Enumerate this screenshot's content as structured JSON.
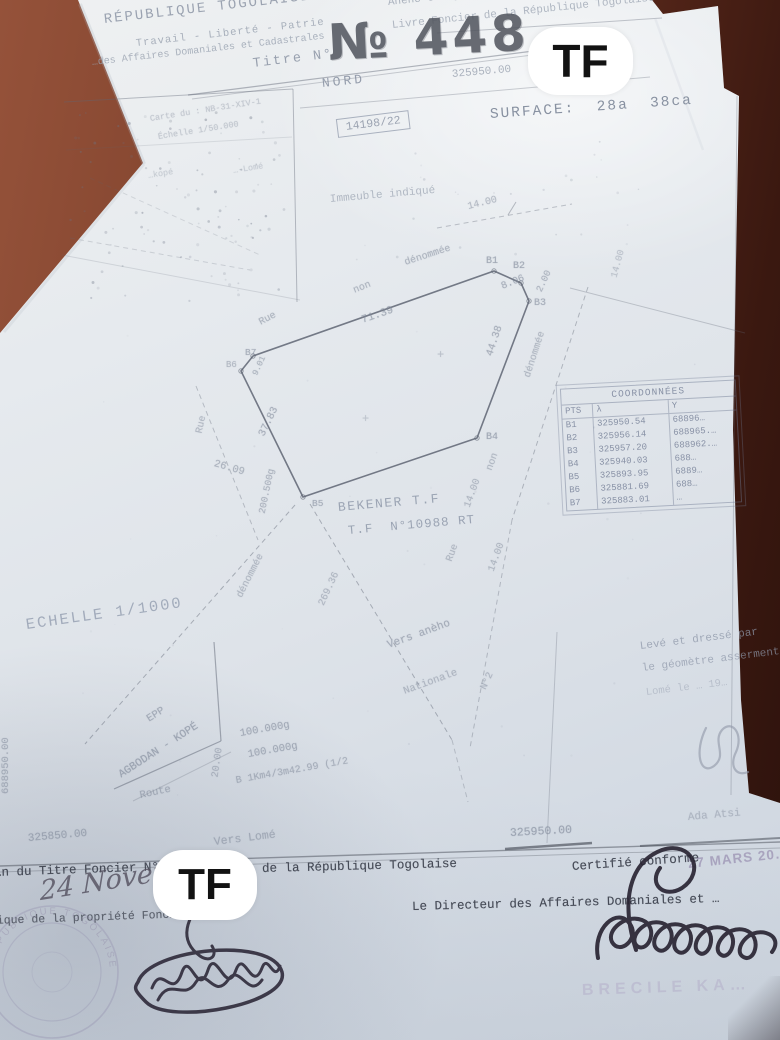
{
  "badges": {
    "tf": "TF"
  },
  "colors": {
    "paper": "#e2e6ec",
    "table_wood": "#7a3f2c",
    "ink_faded": "#8a93a3",
    "ink_dark": "#454a56",
    "stamp_purple": "#8f82a8",
    "badge_bg": "#ffffff",
    "badge_text": "#121212"
  },
  "header": {
    "republic": "RÉPUBLIQUE TOGOLAISE",
    "motto": "Travail - Liberté - Patrie",
    "direction": "…des Affaires Domaniales et Cadastrales",
    "titre_label": "Titre N°",
    "titre_number": "№ 448",
    "office_line1": "Aného Gbodjomé (Pref./LACS)",
    "office_line2": "Livre Foncier de la République Togolaise",
    "grid_x_top": "325950.00",
    "nord": "NORD",
    "surface": "SURFACE:  28a  38ca",
    "file_stamp": "14198/22",
    "immeuble": "Immeuble indiqué"
  },
  "plan": {
    "scale": "ECHELLE 1/1000",
    "owner_line1": "BEKENER T.F",
    "owner_line2": "T.F  N°10988 RT",
    "polygon": {
      "points": [
        [
          494,
          271
        ],
        [
          521,
          283
        ],
        [
          529,
          301
        ],
        [
          477,
          438
        ],
        [
          303,
          497
        ],
        [
          241,
          371
        ],
        [
          253,
          356
        ]
      ]
    },
    "labels": [
      {
        "n": "inset-carte-ref",
        "t": "Carte du : NB-31-XIV-1",
        "x": 150,
        "y": 114,
        "r": -9,
        "s": 8.5,
        "o": 0.38
      },
      {
        "n": "inset-echelle",
        "t": "Échelle 1/50.000",
        "x": 158,
        "y": 132,
        "r": -9,
        "s": 8.5,
        "o": 0.38
      },
      {
        "n": "inset-kope",
        "t": "…kopé",
        "x": 148,
        "y": 171,
        "r": -9,
        "s": 8.5,
        "o": 0.32
      },
      {
        "n": "inset-lome",
        "t": "…-Lomé",
        "x": 233,
        "y": 166,
        "r": -9,
        "s": 8.5,
        "o": 0.32
      },
      {
        "n": "street-north-width",
        "t": "14.00",
        "x": 468,
        "y": 202,
        "r": -14,
        "s": 10,
        "o": 0.5
      },
      {
        "n": "rue-top-word1",
        "t": "Rue",
        "x": 260,
        "y": 318,
        "r": -28,
        "s": 10,
        "o": 0.55
      },
      {
        "n": "rue-top-word2",
        "t": "non",
        "x": 354,
        "y": 286,
        "r": -22,
        "s": 10,
        "o": 0.55
      },
      {
        "n": "rue-top-word3",
        "t": "dénommée",
        "x": 405,
        "y": 258,
        "r": -18,
        "s": 10,
        "o": 0.55
      },
      {
        "n": "len-b7-b1",
        "t": "71.39",
        "x": 362,
        "y": 315,
        "r": -19,
        "s": 11,
        "o": 0.62
      },
      {
        "n": "pt-b1",
        "t": "B1",
        "x": 486,
        "y": 256,
        "r": 0,
        "s": 10,
        "o": 0.65
      },
      {
        "n": "pt-b2",
        "t": "B2",
        "x": 513,
        "y": 261,
        "r": 0,
        "s": 10,
        "o": 0.65
      },
      {
        "n": "len-b1-b2",
        "t": "8.06",
        "x": 502,
        "y": 282,
        "r": -22,
        "s": 10,
        "o": 0.6
      },
      {
        "n": "len-b2-b3",
        "t": "2.00",
        "x": 539,
        "y": 286,
        "r": -65,
        "s": 9.5,
        "o": 0.55
      },
      {
        "n": "pt-b3",
        "t": "B3",
        "x": 534,
        "y": 298,
        "r": 0,
        "s": 10,
        "o": 0.6
      },
      {
        "n": "len-b3-b4",
        "t": "44.38",
        "x": 490,
        "y": 350,
        "r": -72,
        "s": 10.5,
        "o": 0.6
      },
      {
        "n": "rue-right-denommee",
        "t": "dénommée",
        "x": 528,
        "y": 372,
        "r": -72,
        "s": 10,
        "o": 0.5
      },
      {
        "n": "pt-b4",
        "t": "B4",
        "x": 486,
        "y": 432,
        "r": 0,
        "s": 10,
        "o": 0.65
      },
      {
        "n": "pt-b5",
        "t": "B5",
        "x": 312,
        "y": 498,
        "r": 0,
        "s": 9.5,
        "o": 0.6
      },
      {
        "n": "pt-b6",
        "t": "B6",
        "x": 226,
        "y": 360,
        "r": 0,
        "s": 9,
        "o": 0.5
      },
      {
        "n": "pt-b7",
        "t": "B7",
        "x": 245,
        "y": 347,
        "r": 0,
        "s": 9.5,
        "o": 0.6
      },
      {
        "n": "len-b6-b7",
        "t": "9.01",
        "x": 255,
        "y": 370,
        "r": -65,
        "s": 8.5,
        "o": 0.55
      },
      {
        "n": "len-b5-b6",
        "t": "37.83",
        "x": 262,
        "y": 430,
        "r": -64,
        "s": 10.5,
        "o": 0.6
      },
      {
        "n": "rue-left-word",
        "t": "Rue",
        "x": 200,
        "y": 428,
        "r": -78,
        "s": 10,
        "o": 0.5
      },
      {
        "n": "len-rue-left",
        "t": "26.09",
        "x": 214,
        "y": 458,
        "r": 16,
        "s": 10.5,
        "o": 0.55
      },
      {
        "n": "angle-b5",
        "t": "200.500g",
        "x": 262,
        "y": 508,
        "r": -78,
        "s": 9.5,
        "o": 0.55
      },
      {
        "n": "rue-sw-denommee",
        "t": "dénommée",
        "x": 240,
        "y": 592,
        "r": -63,
        "s": 10,
        "o": 0.5
      },
      {
        "n": "len-road-se",
        "t": "269.36",
        "x": 322,
        "y": 600,
        "r": -65,
        "s": 10,
        "o": 0.5
      },
      {
        "n": "rue-right2-word1",
        "t": "non",
        "x": 490,
        "y": 465,
        "r": -70,
        "s": 10,
        "o": 0.5
      },
      {
        "n": "rue-right2-width1",
        "t": "14.00",
        "x": 468,
        "y": 502,
        "r": -70,
        "s": 10,
        "o": 0.5
      },
      {
        "n": "rue-right2-word2",
        "t": "Rue",
        "x": 450,
        "y": 556,
        "r": -70,
        "s": 10,
        "o": 0.5
      },
      {
        "n": "rue-right2-width2",
        "t": "14.00",
        "x": 492,
        "y": 566,
        "r": -70,
        "s": 10,
        "o": 0.5
      },
      {
        "n": "right-street-width",
        "t": "14.00",
        "x": 614,
        "y": 272,
        "r": -75,
        "s": 9.5,
        "o": 0.4
      },
      {
        "n": "vers-aneho",
        "t": "Vers anèho",
        "x": 388,
        "y": 640,
        "r": -20,
        "s": 11,
        "o": 0.6
      },
      {
        "n": "route-nationale",
        "t": "Nationale",
        "x": 404,
        "y": 686,
        "r": -20,
        "s": 10.5,
        "o": 0.5
      },
      {
        "n": "route-n2",
        "t": "N°2",
        "x": 484,
        "y": 684,
        "r": -65,
        "s": 10,
        "o": 0.5
      },
      {
        "n": "epp-label",
        "t": "EPP",
        "x": 148,
        "y": 714,
        "r": -32,
        "s": 10.5,
        "o": 0.6
      },
      {
        "n": "agbodan-kope",
        "t": "AGBODAN - KOPÉ",
        "x": 120,
        "y": 770,
        "r": -33,
        "s": 11,
        "o": 0.65
      },
      {
        "n": "route-word",
        "t": "Route",
        "x": 140,
        "y": 790,
        "r": -12,
        "s": 10.5,
        "o": 0.55
      },
      {
        "n": "angle-epp-1",
        "t": "100.000g",
        "x": 240,
        "y": 728,
        "r": -10,
        "s": 10.5,
        "o": 0.6
      },
      {
        "n": "angle-epp-2",
        "t": "100.000g",
        "x": 248,
        "y": 749,
        "r": -10,
        "s": 10.5,
        "o": 0.6
      },
      {
        "n": "bearing-line",
        "t": "B 1Km4/3m42.99 (1/2",
        "x": 236,
        "y": 776,
        "r": -10,
        "s": 10,
        "o": 0.55
      },
      {
        "n": "width-epp",
        "t": "20.00",
        "x": 216,
        "y": 772,
        "r": -82,
        "s": 10,
        "o": 0.5
      },
      {
        "n": "grid-y-left",
        "t": "688950.00",
        "x": 6,
        "y": 788,
        "r": -90,
        "s": 10.5,
        "o": 0.55
      },
      {
        "n": "plus-mark-1",
        "t": "+",
        "x": 437,
        "y": 348,
        "r": 0,
        "s": 12,
        "o": 0.4
      },
      {
        "n": "plus-mark-2",
        "t": "+",
        "x": 362,
        "y": 412,
        "r": 0,
        "s": 12,
        "o": 0.35
      },
      {
        "n": "grid-x-left",
        "t": "325850.00",
        "x": 28,
        "y": 833,
        "r": -5,
        "s": 11,
        "o": 0.6
      },
      {
        "n": "vers-lome",
        "t": "Vers Lomé",
        "x": 214,
        "y": 836,
        "r": -7,
        "s": 11.5,
        "o": 0.55
      },
      {
        "n": "grid-x-right",
        "t": "325950.00",
        "x": 510,
        "y": 827,
        "r": -3,
        "s": 11.5,
        "o": 0.65
      },
      {
        "n": "place-ada",
        "t": "Ada Atsi",
        "x": 688,
        "y": 812,
        "r": -5,
        "s": 11,
        "o": 0.45
      }
    ],
    "lines": [
      {
        "x1": 188,
        "y1": 95,
        "x2": 612,
        "y2": 41,
        "o": 0.45,
        "w": 1.2
      },
      {
        "x1": 192,
        "y1": 99,
        "x2": 610,
        "y2": 45,
        "o": 0.3,
        "w": 1
      },
      {
        "x1": 300,
        "y1": 108,
        "x2": 650,
        "y2": 77,
        "o": 0.3,
        "w": 1
      },
      {
        "x1": 437,
        "y1": 33,
        "x2": 662,
        "y2": 18,
        "o": 0.35,
        "w": 1
      },
      {
        "x1": 437,
        "y1": 228,
        "x2": 572,
        "y2": 204,
        "d": 1,
        "o": 0.35,
        "w": 1
      },
      {
        "x1": 508,
        "y1": 215,
        "x2": 516,
        "y2": 202,
        "o": 0.4,
        "w": 1
      },
      {
        "x1": 588,
        "y1": 287,
        "x2": 512,
        "y2": 520,
        "d": 1,
        "o": 0.4,
        "w": 1
      },
      {
        "x1": 512,
        "y1": 520,
        "x2": 470,
        "y2": 748,
        "d": 1,
        "o": 0.35,
        "w": 1
      },
      {
        "x1": 570,
        "y1": 288,
        "x2": 745,
        "y2": 333,
        "o": 0.3,
        "w": 1
      },
      {
        "x1": 737,
        "y1": 96,
        "x2": 731,
        "y2": 795,
        "o": 0.3,
        "w": 1
      },
      {
        "x1": 295,
        "y1": 505,
        "x2": 85,
        "y2": 744,
        "d": 1,
        "o": 0.45,
        "w": 1
      },
      {
        "x1": 310,
        "y1": 504,
        "x2": 452,
        "y2": 740,
        "d": 1,
        "o": 0.45,
        "w": 1
      },
      {
        "x1": 452,
        "y1": 740,
        "x2": 468,
        "y2": 802,
        "d": 1,
        "o": 0.3,
        "w": 1
      },
      {
        "x1": 196,
        "y1": 386,
        "x2": 258,
        "y2": 540,
        "d": 1,
        "o": 0.35,
        "w": 1
      },
      {
        "x1": 214,
        "y1": 642,
        "x2": 221,
        "y2": 741,
        "o": 0.5,
        "w": 1.2
      },
      {
        "x1": 221,
        "y1": 741,
        "x2": 114,
        "y2": 789,
        "o": 0.5,
        "w": 1.2
      },
      {
        "x1": 231,
        "y1": 752,
        "x2": 133,
        "y2": 801,
        "o": 0.25,
        "w": 1
      },
      {
        "x1": 0,
        "y1": 866,
        "x2": 780,
        "y2": 842,
        "o": 0.5,
        "w": 1.4,
        "c": "#4a4f5a"
      },
      {
        "x1": 0,
        "y1": 872,
        "x2": 780,
        "y2": 848,
        "o": 0.3,
        "w": 1,
        "c": "#4a4f5a"
      },
      {
        "x1": 505,
        "y1": 849,
        "x2": 592,
        "y2": 843,
        "o": 0.6,
        "w": 2.5,
        "c": "#3c414c"
      },
      {
        "x1": 640,
        "y1": 846,
        "x2": 780,
        "y2": 838,
        "o": 0.5,
        "w": 2,
        "c": "#3c414c"
      },
      {
        "x1": 557,
        "y1": 632,
        "x2": 547,
        "y2": 843,
        "o": 0.28,
        "w": 1
      },
      {
        "x1": 64,
        "y1": 102,
        "x2": 293,
        "y2": 89,
        "o": 0.4,
        "w": 1
      },
      {
        "x1": 293,
        "y1": 89,
        "x2": 297,
        "y2": 302,
        "o": 0.4,
        "w": 1
      },
      {
        "x1": 66,
        "y1": 150,
        "x2": 292,
        "y2": 137,
        "o": 0.15,
        "w": 1
      },
      {
        "x1": 70,
        "y1": 238,
        "x2": 250,
        "y2": 270,
        "d": 1,
        "o": 0.22,
        "w": 1
      },
      {
        "x1": 90,
        "y1": 178,
        "x2": 260,
        "y2": 255,
        "d": 1,
        "o": 0.18,
        "w": 1
      },
      {
        "x1": 62,
        "y1": 255,
        "x2": 300,
        "y2": 300,
        "o": 0.18,
        "w": 1
      },
      {
        "x1": 80,
        "y1": 4,
        "x2": 144,
        "y2": 164,
        "o": 0.25,
        "w": 4,
        "c": "#aeb6c1"
      },
      {
        "x1": 144,
        "y1": 164,
        "x2": 4,
        "y2": 332,
        "o": 0.2,
        "w": 3,
        "c": "#aeb6c1"
      },
      {
        "x1": 655,
        "y1": 18,
        "x2": 703,
        "y2": 150,
        "o": 0.2,
        "w": 2.5,
        "c": "#c2c9d2"
      }
    ]
  },
  "coordinates_table": {
    "title": "COORDONNÉES",
    "columns": [
      "PTS",
      "λ",
      "Y"
    ],
    "rows": [
      [
        "B1",
        "325950.54",
        "68896…"
      ],
      [
        "B2",
        "325956.14",
        "688965.…"
      ],
      [
        "B3",
        "325957.20",
        "688962.…"
      ],
      [
        "B4",
        "325940.03",
        "688…"
      ],
      [
        "B5",
        "325893.95",
        "6889…"
      ],
      [
        "B6",
        "325881.69",
        "688…"
      ],
      [
        "B7",
        "325883.01",
        "…"
      ]
    ]
  },
  "surveyor": {
    "line1": "Levé et dressé par",
    "line2": "le géomètre assermenté",
    "line3": "Lomé le … 19…"
  },
  "footer": {
    "titre_line_left": "…n du Titre Foncier N°",
    "titre_line_right": "de la République Togolaise",
    "certify": "Certifié conforme",
    "date_stamp": "27 MARS 20…",
    "director": "Le Directeur des Affaires Domaniales et …",
    "handwritten_date": "24 Novem…",
    "propriete": "…ique de la propriété Foncière",
    "seal_text": "RÉPUBLIQUE TOGOLAISE",
    "faint_name": "BRECILE KA…"
  }
}
